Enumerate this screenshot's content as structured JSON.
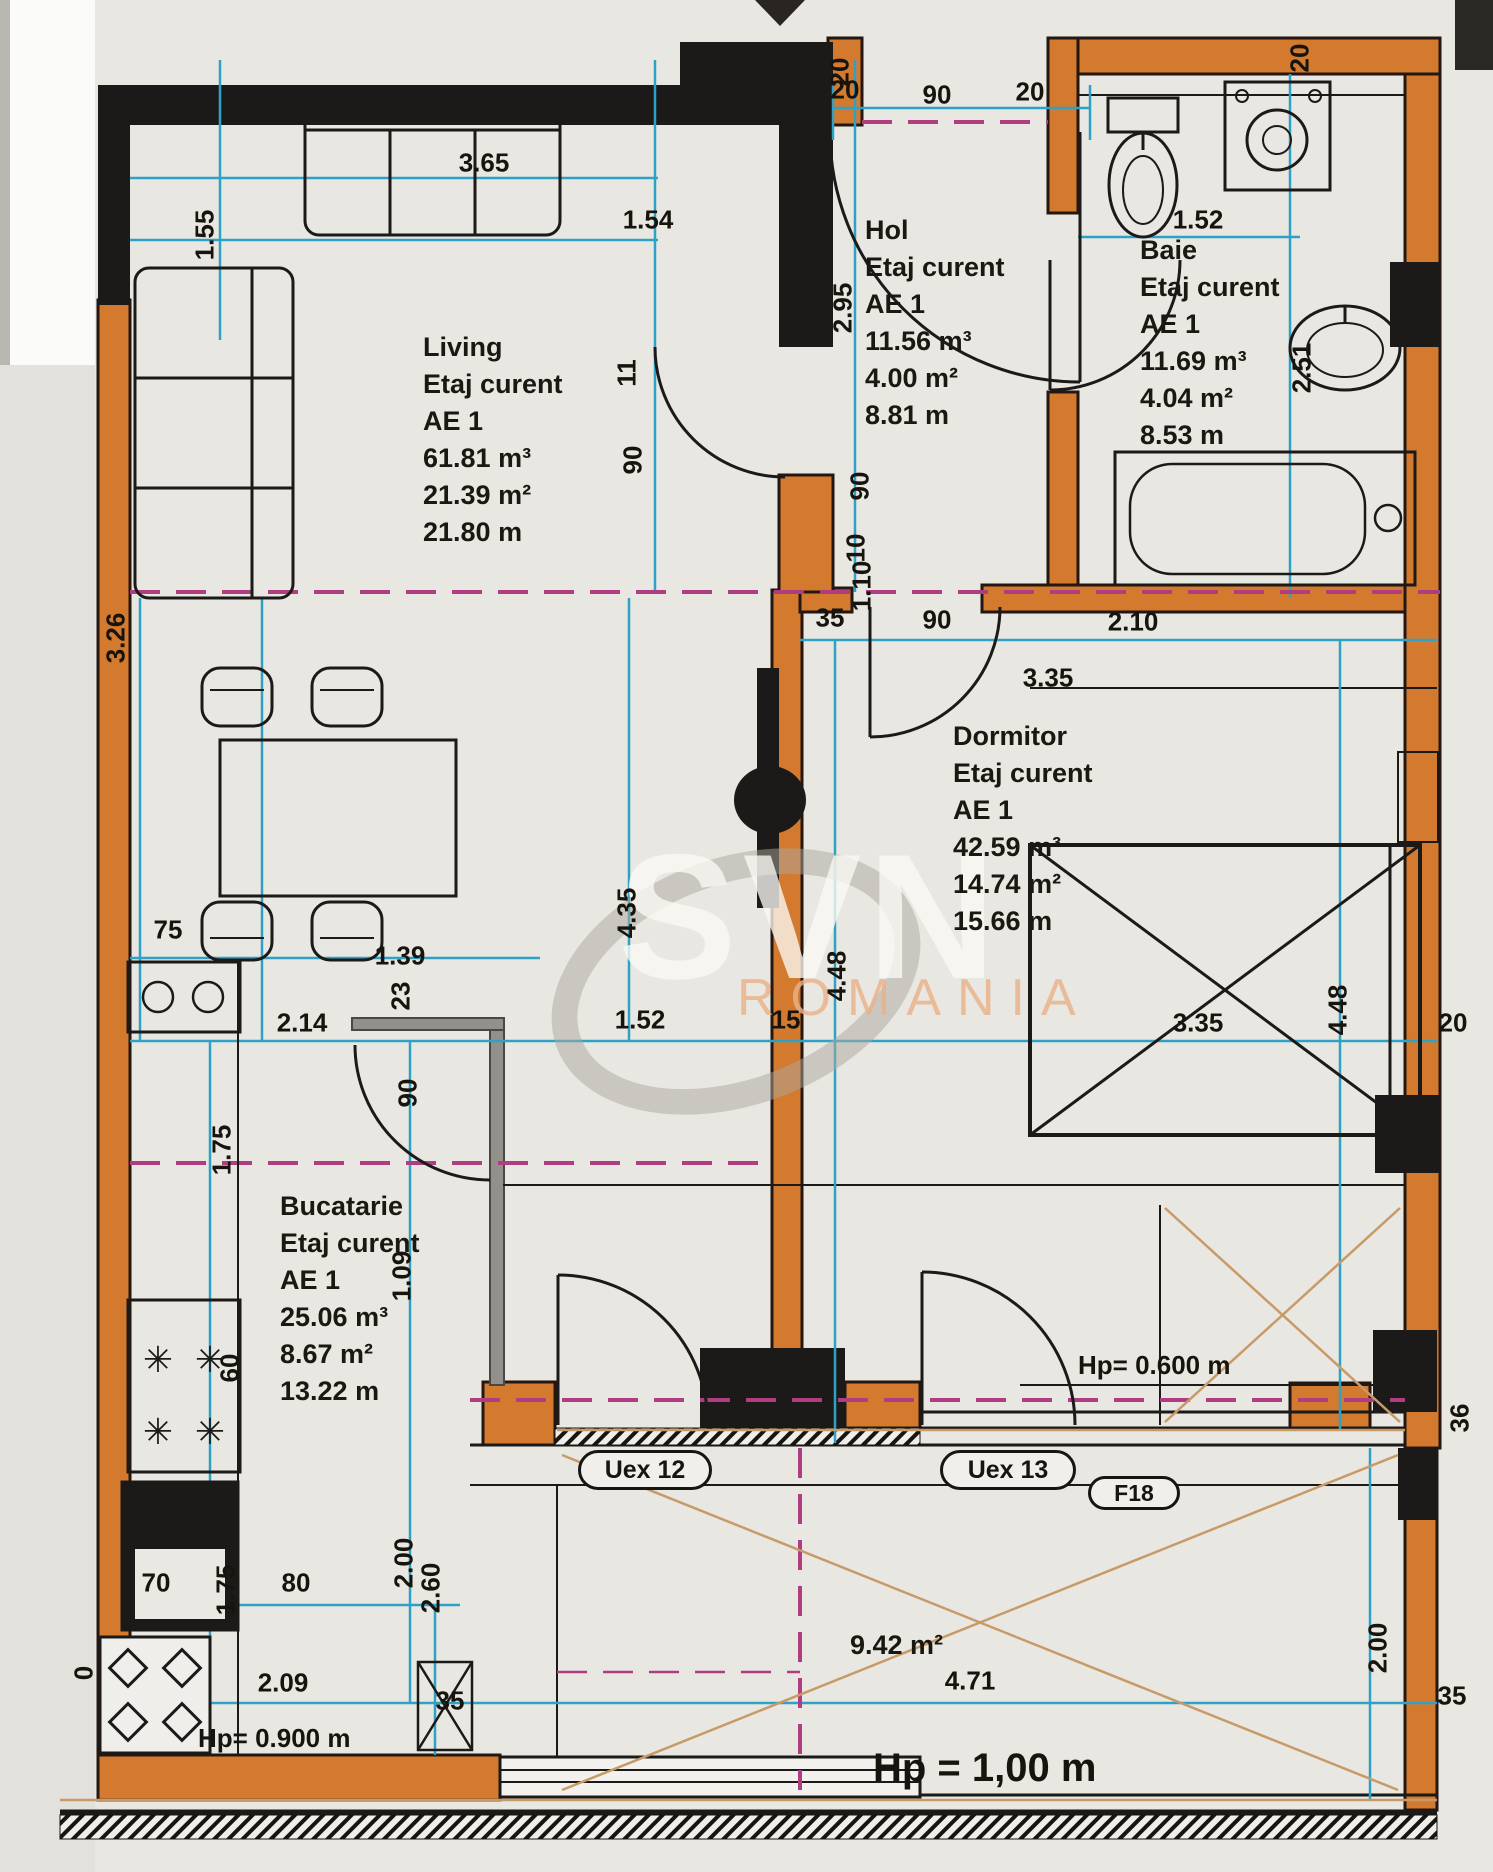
{
  "watermark": {
    "brand": "SVN",
    "country": "ROMANIA"
  },
  "colors": {
    "wall_orange": "#d47a2e",
    "wall_black": "#1c1a18",
    "dim_cyan": "#2ea2c6",
    "section_magenta": "#b03d82",
    "balcony_tan": "#c89a68"
  },
  "rooms": {
    "living": {
      "name": "Living",
      "floor": "Etaj curent",
      "unit": "AE 1",
      "volume": "61.81 m³",
      "area": "21.39 m²",
      "perimeter": "21.80 m"
    },
    "hol": {
      "name": "Hol",
      "floor": "Etaj curent",
      "unit": "AE 1",
      "volume": "11.56 m³",
      "area": "4.00 m²",
      "perimeter": "8.81 m"
    },
    "baie": {
      "name": "Baie",
      "floor": "Etaj curent",
      "unit": "AE 1",
      "volume": "11.69 m³",
      "area": "4.04 m²",
      "perimeter": "8.53 m"
    },
    "dormitor": {
      "name": "Dormitor",
      "floor": "Etaj curent",
      "unit": "AE 1",
      "volume": "42.59 m³",
      "area": "14.74 m²",
      "perimeter": "15.66 m"
    },
    "bucatarie": {
      "name": "Bucatarie",
      "floor": "Etaj curent",
      "unit": "AE 1",
      "volume": "25.06 m³",
      "area": "8.67 m²",
      "perimeter": "13.22 m"
    }
  },
  "balcony": {
    "area": "9.42 m²",
    "width": "4.71",
    "parapet": "Hp = 1,00 m"
  },
  "parapets": {
    "window": "Hp= 0.600 m",
    "kitchen": "Hp= 0.900 m"
  },
  "openings": {
    "uex12": "Uex 12",
    "uex13": "Uex 13",
    "f18": "F18"
  },
  "dimensions": [
    {
      "t": "3.65",
      "x": 484,
      "y": 163
    },
    {
      "t": "1.55",
      "x": 205,
      "y": 235,
      "r": 1
    },
    {
      "t": "1.54",
      "x": 648,
      "y": 220
    },
    {
      "t": "20",
      "x": 840,
      "y": 72,
      "r": 1
    },
    {
      "t": "20",
      "x": 845,
      "y": 90
    },
    {
      "t": "90",
      "x": 937,
      "y": 95
    },
    {
      "t": "20",
      "x": 1030,
      "y": 92
    },
    {
      "t": "20",
      "x": 1300,
      "y": 58,
      "r": 1
    },
    {
      "t": "1.52",
      "x": 1198,
      "y": 220
    },
    {
      "t": "2.95",
      "x": 843,
      "y": 308,
      "r": 1
    },
    {
      "t": "2.51",
      "x": 1302,
      "y": 368,
      "r": 1
    },
    {
      "t": "11",
      "x": 627,
      "y": 373,
      "r": 1
    },
    {
      "t": "90",
      "x": 633,
      "y": 460,
      "r": 1
    },
    {
      "t": "90",
      "x": 860,
      "y": 486,
      "r": 1
    },
    {
      "t": "10",
      "x": 856,
      "y": 548,
      "r": 1
    },
    {
      "t": "1.10",
      "x": 862,
      "y": 586,
      "r": 1
    },
    {
      "t": "35",
      "x": 830,
      "y": 618
    },
    {
      "t": "90",
      "x": 937,
      "y": 620
    },
    {
      "t": "2.10",
      "x": 1133,
      "y": 622
    },
    {
      "t": "3.35",
      "x": 1048,
      "y": 678
    },
    {
      "t": "3.26",
      "x": 116,
      "y": 638,
      "r": 1
    },
    {
      "t": "4.35",
      "x": 627,
      "y": 913,
      "r": 1
    },
    {
      "t": "4.48",
      "x": 837,
      "y": 976,
      "r": 1
    },
    {
      "t": "4.48",
      "x": 1338,
      "y": 1010,
      "r": 1
    },
    {
      "t": "75",
      "x": 168,
      "y": 930
    },
    {
      "t": "1.39",
      "x": 400,
      "y": 956
    },
    {
      "t": "2.14",
      "x": 302,
      "y": 1023
    },
    {
      "t": "23",
      "x": 401,
      "y": 996,
      "r": 1
    },
    {
      "t": "1.52",
      "x": 640,
      "y": 1020
    },
    {
      "t": "15",
      "x": 786,
      "y": 1020
    },
    {
      "t": "3.35",
      "x": 1198,
      "y": 1023
    },
    {
      "t": "20",
      "x": 1453,
      "y": 1023
    },
    {
      "t": "90",
      "x": 408,
      "y": 1093,
      "r": 1
    },
    {
      "t": "1.75",
      "x": 222,
      "y": 1150,
      "r": 1
    },
    {
      "t": "1.09",
      "x": 402,
      "y": 1276,
      "r": 1
    },
    {
      "t": "60",
      "x": 230,
      "y": 1368,
      "r": 1
    },
    {
      "t": "36",
      "x": 1460,
      "y": 1418,
      "r": 1
    },
    {
      "t": "70",
      "x": 156,
      "y": 1583
    },
    {
      "t": "1.75",
      "x": 226,
      "y": 1590,
      "r": 1
    },
    {
      "t": "80",
      "x": 296,
      "y": 1583
    },
    {
      "t": "2.00",
      "x": 404,
      "y": 1563,
      "r": 1
    },
    {
      "t": "2.60",
      "x": 431,
      "y": 1588,
      "r": 1
    },
    {
      "t": "2.09",
      "x": 283,
      "y": 1683
    },
    {
      "t": "35",
      "x": 450,
      "y": 1701
    },
    {
      "t": "0",
      "x": 84,
      "y": 1673,
      "r": 1
    },
    {
      "t": "4.71",
      "x": 970,
      "y": 1681
    },
    {
      "t": "2.00",
      "x": 1378,
      "y": 1648,
      "r": 1
    },
    {
      "t": "35",
      "x": 1452,
      "y": 1696
    }
  ]
}
